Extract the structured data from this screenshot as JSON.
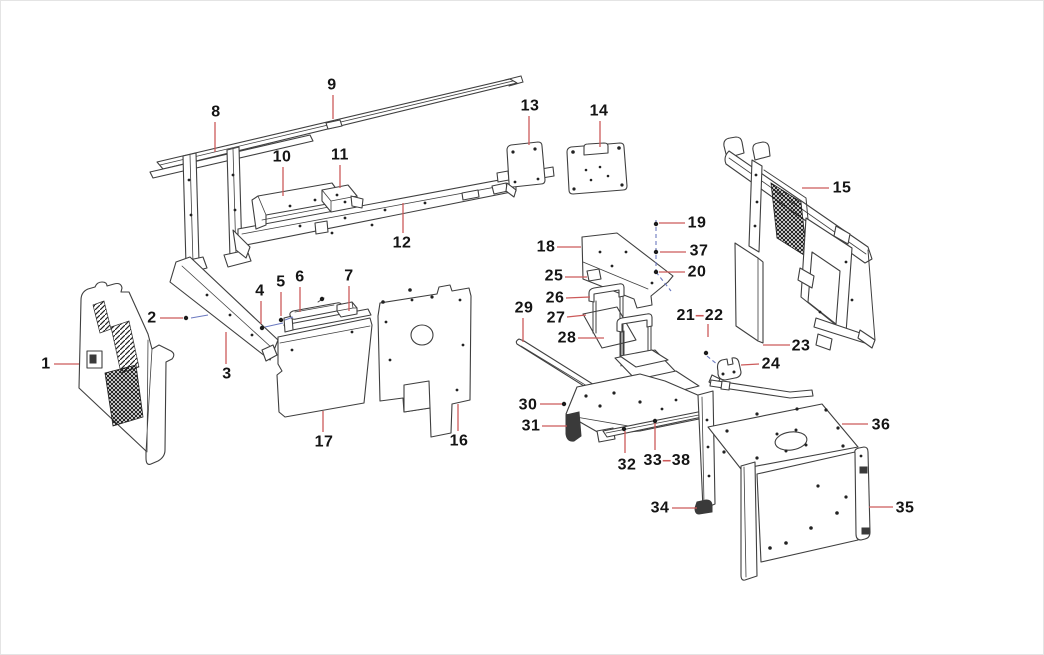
{
  "diagram": {
    "background": "#ffffff",
    "stroke_color": "#3f3f3f",
    "leader_color": "#cc5a5a",
    "construction_color": "#6b79c0",
    "label_color": "#141414",
    "callouts": [
      {
        "label": "1",
        "x": 46,
        "y": 364,
        "leader": [
          [
            54,
            364
          ],
          [
            79,
            364
          ]
        ]
      },
      {
        "label": "2",
        "x": 152,
        "y": 318,
        "leader": [
          [
            160,
            318
          ],
          [
            183,
            318
          ]
        ]
      },
      {
        "label": "3",
        "x": 227,
        "y": 374,
        "leader": [
          [
            226,
            364
          ],
          [
            226,
            332
          ]
        ]
      },
      {
        "label": "4",
        "x": 260,
        "y": 291,
        "leader": [
          [
            261,
            301
          ],
          [
            261,
            324
          ]
        ]
      },
      {
        "label": "5",
        "x": 281,
        "y": 282,
        "leader": [
          [
            281,
            292
          ],
          [
            281,
            316
          ]
        ]
      },
      {
        "label": "6",
        "x": 300,
        "y": 277,
        "leader": [
          [
            300,
            287
          ],
          [
            300,
            312
          ]
        ]
      },
      {
        "label": "7",
        "x": 349,
        "y": 276,
        "leader": [
          [
            349,
            286
          ],
          [
            349,
            311
          ]
        ]
      },
      {
        "label": "8",
        "x": 216,
        "y": 112,
        "leader": [
          [
            215,
            122
          ],
          [
            215,
            152
          ]
        ]
      },
      {
        "label": "9",
        "x": 332,
        "y": 85,
        "leader": [
          [
            333,
            95
          ],
          [
            333,
            119
          ]
        ]
      },
      {
        "label": "10",
        "x": 282,
        "y": 157,
        "leader": [
          [
            283,
            167
          ],
          [
            283,
            196
          ]
        ]
      },
      {
        "label": "11",
        "x": 340,
        "y": 155,
        "leader": [
          [
            340,
            165
          ],
          [
            340,
            188
          ]
        ]
      },
      {
        "label": "12",
        "x": 402,
        "y": 243,
        "leader": [
          [
            403,
            233
          ],
          [
            403,
            203
          ]
        ]
      },
      {
        "label": "13",
        "x": 530,
        "y": 106,
        "leader": [
          [
            529,
            116
          ],
          [
            529,
            145
          ]
        ]
      },
      {
        "label": "14",
        "x": 599,
        "y": 111,
        "leader": [
          [
            600,
            121
          ],
          [
            600,
            147
          ]
        ]
      },
      {
        "label": "15",
        "x": 842,
        "y": 188,
        "leader": [
          [
            829,
            188
          ],
          [
            802,
            188
          ]
        ]
      },
      {
        "label": "16",
        "x": 459,
        "y": 441,
        "leader": [
          [
            458,
            431
          ],
          [
            458,
            404
          ]
        ]
      },
      {
        "label": "17",
        "x": 324,
        "y": 442,
        "leader": [
          [
            323,
            432
          ],
          [
            323,
            411
          ]
        ]
      },
      {
        "label": "18",
        "x": 546,
        "y": 247,
        "leader": [
          [
            557,
            247
          ],
          [
            581,
            247
          ]
        ]
      },
      {
        "label": "19",
        "x": 697,
        "y": 223,
        "leader": [
          [
            685,
            223
          ],
          [
            659,
            223
          ]
        ]
      },
      {
        "label": "37",
        "x": 699,
        "y": 251,
        "leader": [
          [
            686,
            252
          ],
          [
            660,
            252
          ]
        ]
      },
      {
        "label": "20",
        "x": 697,
        "y": 272,
        "leader": [
          [
            685,
            272
          ],
          [
            659,
            272
          ]
        ]
      },
      {
        "label": "21-22",
        "x": 700,
        "y": 315,
        "leader": [
          [
            708,
            324
          ],
          [
            708,
            337
          ]
        ]
      },
      {
        "label": "23",
        "x": 801,
        "y": 346,
        "leader": [
          [
            790,
            345
          ],
          [
            763,
            345
          ]
        ]
      },
      {
        "label": "24",
        "x": 771,
        "y": 364,
        "leader": [
          [
            759,
            364
          ],
          [
            741,
            365
          ]
        ]
      },
      {
        "label": "25",
        "x": 554,
        "y": 276,
        "leader": [
          [
            565,
            277
          ],
          [
            587,
            277
          ]
        ]
      },
      {
        "label": "26",
        "x": 555,
        "y": 298,
        "leader": [
          [
            566,
            298
          ],
          [
            590,
            297
          ]
        ]
      },
      {
        "label": "27",
        "x": 556,
        "y": 318,
        "leader": [
          [
            567,
            317
          ],
          [
            586,
            315
          ]
        ]
      },
      {
        "label": "28",
        "x": 567,
        "y": 338,
        "leader": [
          [
            578,
            338
          ],
          [
            604,
            338
          ]
        ]
      },
      {
        "label": "29",
        "x": 524,
        "y": 308,
        "leader": [
          [
            523,
            318
          ],
          [
            523,
            342
          ]
        ]
      },
      {
        "label": "30",
        "x": 528,
        "y": 405,
        "leader": [
          [
            540,
            404
          ],
          [
            562,
            404
          ]
        ]
      },
      {
        "label": "31",
        "x": 531,
        "y": 426,
        "leader": [
          [
            542,
            426
          ],
          [
            567,
            426
          ]
        ]
      },
      {
        "label": "32",
        "x": 627,
        "y": 465,
        "leader": [
          [
            625,
            453
          ],
          [
            625,
            431
          ]
        ]
      },
      {
        "label": "33-38",
        "x": 667,
        "y": 460,
        "leader": [
          [
            655,
            450
          ],
          [
            655,
            423
          ]
        ]
      },
      {
        "label": "34",
        "x": 660,
        "y": 508,
        "leader": [
          [
            672,
            508
          ],
          [
            697,
            508
          ]
        ]
      },
      {
        "label": "35",
        "x": 905,
        "y": 508,
        "leader": [
          [
            893,
            507
          ],
          [
            869,
            507
          ]
        ]
      },
      {
        "label": "36",
        "x": 881,
        "y": 425,
        "leader": [
          [
            868,
            424
          ],
          [
            842,
            424
          ]
        ]
      }
    ],
    "construction_lines": [
      {
        "points": [
          [
            191,
            318
          ],
          [
            208,
            315
          ]
        ],
        "dashed": false
      },
      {
        "points": [
          [
            265,
            327
          ],
          [
            283,
            323
          ]
        ],
        "dashed": false
      },
      {
        "points": [
          [
            285,
            320
          ],
          [
            293,
            317
          ]
        ],
        "dashed": false
      },
      {
        "points": [
          [
            656,
            220
          ],
          [
            656,
            272
          ]
        ],
        "dashed": true
      },
      {
        "points": [
          [
            656,
            272
          ],
          [
            671,
            291
          ]
        ],
        "dashed": true
      },
      {
        "points": [
          [
            707,
            356
          ],
          [
            718,
            365
          ]
        ],
        "dashed": true
      }
    ],
    "fasteners": [
      [
        186,
        318
      ],
      [
        262,
        328
      ],
      [
        281,
        320
      ],
      [
        322,
        299
      ],
      [
        656,
        224
      ],
      [
        656,
        252
      ],
      [
        656,
        272
      ],
      [
        706,
        353
      ],
      [
        564,
        404
      ],
      [
        624,
        429
      ],
      [
        655,
        421
      ]
    ]
  }
}
